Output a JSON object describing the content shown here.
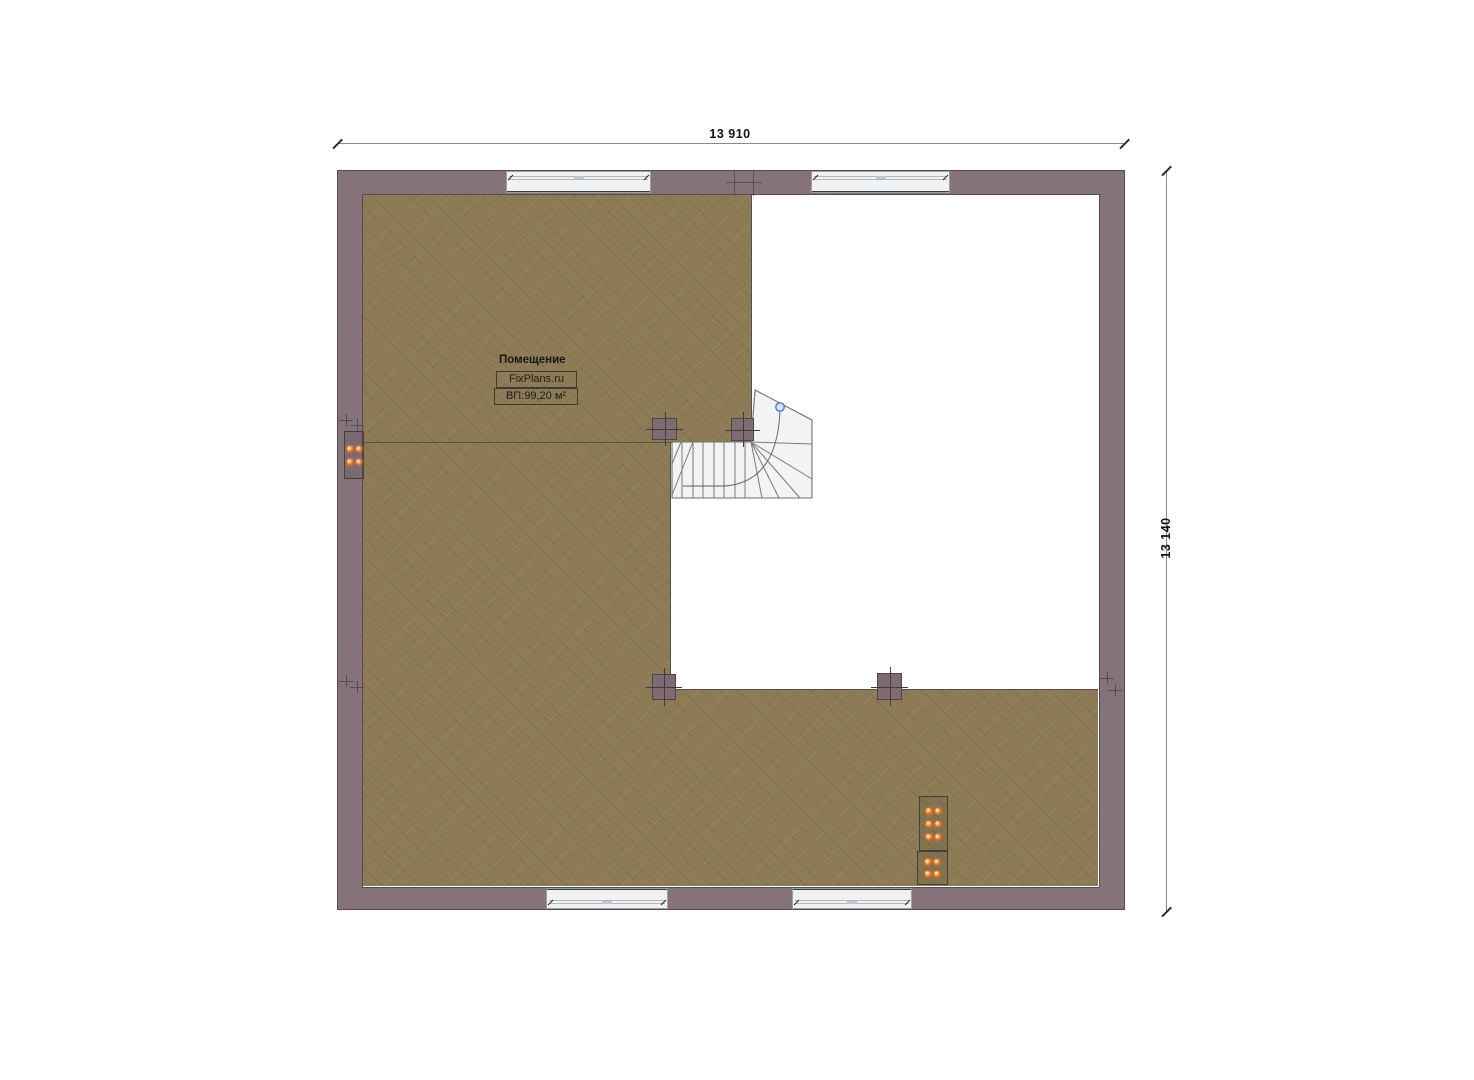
{
  "dimensions": {
    "top": "13 910",
    "right": "13 140"
  },
  "room": {
    "name": "Помещение",
    "brand": "FixPlans.ru",
    "area": "ВП:99,20 м²"
  },
  "colors": {
    "wall": "#85727A",
    "floor": "#8C7B55",
    "stair_fill": "#F2F3F4",
    "window_fill": "#EFF1F2",
    "column": "#7E6B73",
    "outlet_orange": "#FF8125",
    "stair_marker_blue": "#3B6FD4"
  },
  "icons": {
    "stair_start_marker": "small blue circle",
    "outlet": "orange glowing dot",
    "axis_marker": "plus cross"
  }
}
